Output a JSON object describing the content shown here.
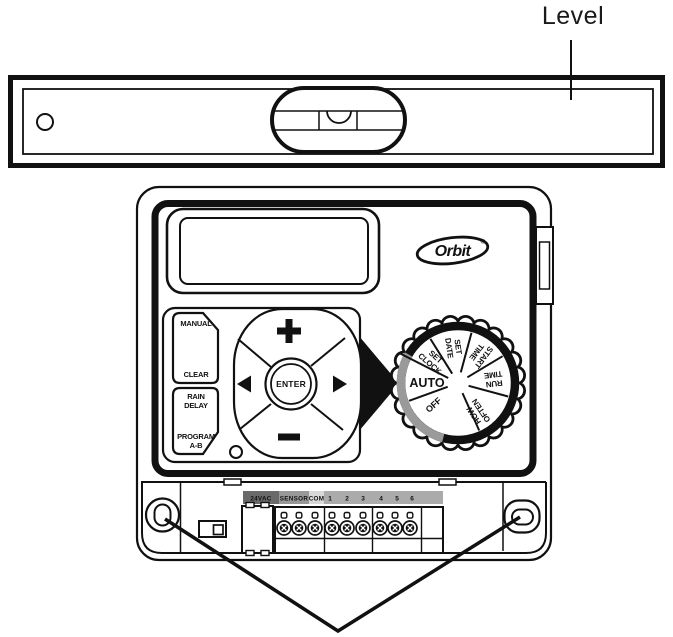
{
  "figure": {
    "title_callout": "Level"
  },
  "brand": {
    "logo_text": "Orbit",
    "registered_mark": "®"
  },
  "keypad": {
    "manual_label": "MANUAL",
    "clear_label": "CLEAR",
    "rain_delay": [
      "RAIN",
      "DELAY"
    ],
    "program_ab": [
      "PROGRAM",
      "A-B"
    ],
    "enter_label": "ENTER"
  },
  "icons": {
    "increase": "+",
    "decrease": "−",
    "navigate_left": "◀",
    "navigate_right": "▶"
  },
  "dial": {
    "positions": [
      {
        "id": "auto",
        "lines": [
          "AUTO"
        ]
      },
      {
        "id": "set-clock",
        "lines": [
          "SET",
          "CLOCK"
        ]
      },
      {
        "id": "set-date",
        "lines": [
          "SET",
          "DATE"
        ]
      },
      {
        "id": "start-time",
        "lines": [
          "START",
          "TIME"
        ]
      },
      {
        "id": "run-time",
        "lines": [
          "RUN",
          "TIME"
        ]
      },
      {
        "id": "how-often",
        "lines": [
          "HOW",
          "OFTEN"
        ]
      },
      {
        "id": "off",
        "lines": [
          "OFF"
        ]
      }
    ],
    "ring_color": "#111111",
    "highlight_arc_color": "#9a9a9a"
  },
  "terminals": {
    "power_label": "24VAC",
    "sensor_label": "SENSOR",
    "common_label": "COM",
    "zone_labels": [
      "1",
      "2",
      "3",
      "4",
      "5",
      "6"
    ],
    "colors": {
      "power_bg": "#6a6a6a",
      "sensor_bg": "#989898",
      "common_bg": "#d8d8d8",
      "zones_bg": "#ababab"
    }
  },
  "line_color": "#111111"
}
